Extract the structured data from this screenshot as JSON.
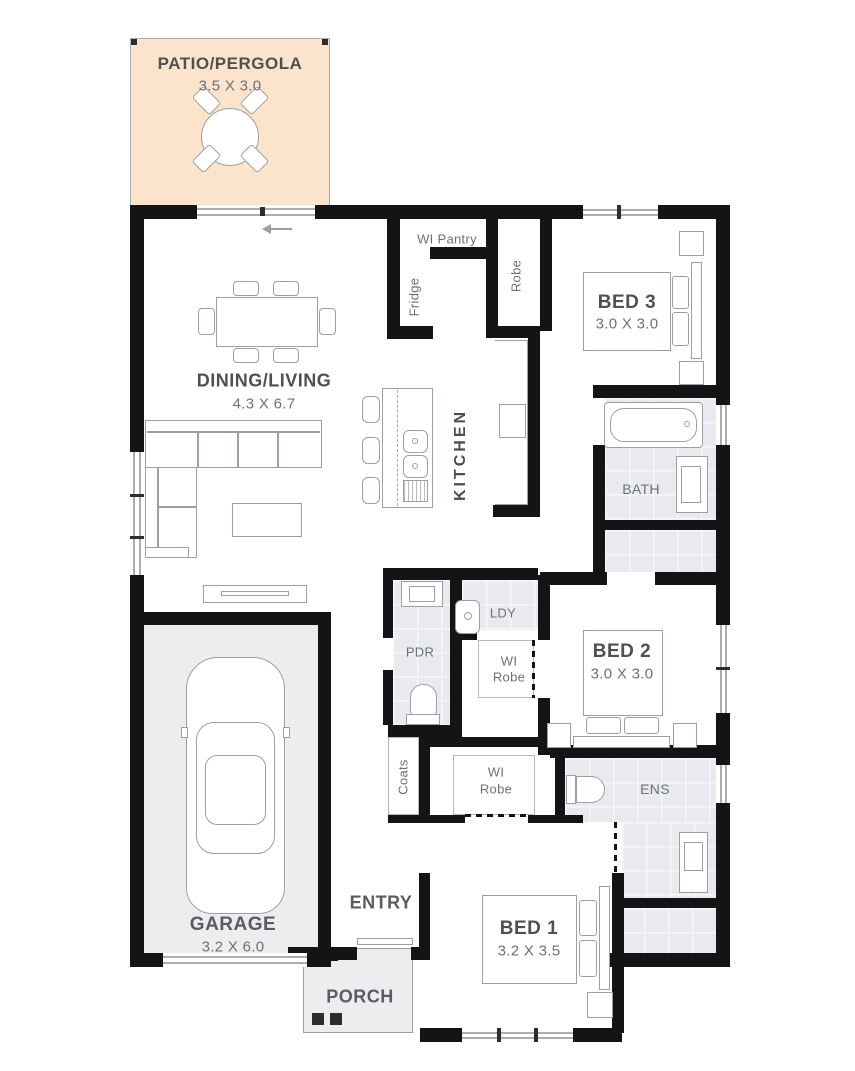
{
  "title": "Single storey house floor plan",
  "colors": {
    "wall": "#141417",
    "tile": "#e8eaed",
    "patio": "#fbe3cc",
    "floor": "#ededef",
    "furniture_stroke": "#9aa0a6",
    "label_dark": "#4d5054",
    "label_mid": "#6e7174"
  },
  "rooms": {
    "patio": {
      "name": "PATIO/PERGOLA",
      "dims": "3.5 X 3.0"
    },
    "dining_living": {
      "name": "DINING/LIVING",
      "dims": "4.3 X 6.7"
    },
    "kitchen": {
      "name": "KITCHEN"
    },
    "wi_pantry": {
      "name": "WI Pantry"
    },
    "fridge": {
      "name": "Fridge"
    },
    "robe": {
      "name": "Robe"
    },
    "bed3": {
      "name": "BED 3",
      "dims": "3.0 X 3.0"
    },
    "bath": {
      "name": "BATH"
    },
    "bed2": {
      "name": "BED 2",
      "dims": "3.0 X 3.0"
    },
    "laundry": {
      "name": "LDY"
    },
    "powder": {
      "name": "PDR"
    },
    "wi_robe_bed2": {
      "line1": "WI",
      "line2": "Robe"
    },
    "coats": {
      "name": "Coats"
    },
    "wi_robe_bed1": {
      "line1": "WI",
      "line2": "Robe"
    },
    "ensuite": {
      "name": "ENS"
    },
    "entry": {
      "name": "ENTRY"
    },
    "bed1": {
      "name": "BED 1",
      "dims": "3.2 X 3.5"
    },
    "garage": {
      "name": "GARAGE",
      "dims": "3.2 X 6.0"
    },
    "porch": {
      "name": "PORCH"
    }
  },
  "fixtures": [
    "round-outdoor-table-with-4-chairs",
    "dining-table-with-6-chairs",
    "l-shaped-sofa",
    "coffee-table",
    "tv-unit",
    "kitchen-island-with-double-sink",
    "three-stools",
    "cooktop",
    "double-bed-bed3",
    "double-bed-bed2",
    "double-bed-bed1",
    "bathtub",
    "bath-vanity",
    "powder-vanity",
    "toilet-powder",
    "laundry-tub",
    "toilet-ensuite",
    "ensuite-vanity",
    "car-top-view",
    "sliding-door",
    "porch-posts"
  ]
}
